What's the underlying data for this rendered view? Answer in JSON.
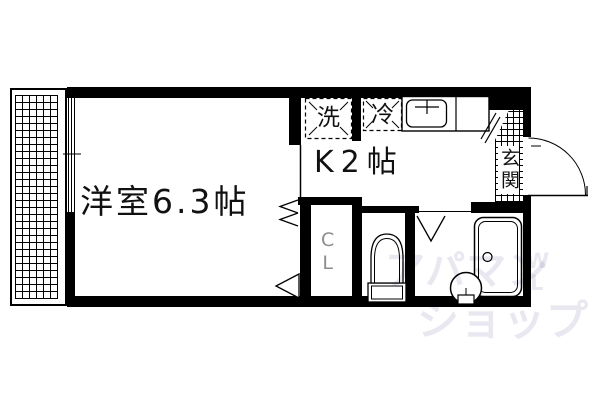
{
  "floorplan": {
    "title": "1K apartment floor plan",
    "rooms": {
      "western_room": {
        "label": "洋室6.3帖"
      },
      "kitchen": {
        "label": "K2帖"
      },
      "entrance": {
        "label": "玄関"
      },
      "closet": {
        "letter_c": "C",
        "letter_l": "L"
      }
    },
    "fixtures": {
      "washer": {
        "label": "洗"
      },
      "fridge": {
        "label": "冷"
      }
    },
    "watermark": {
      "line1": "アパマン",
      "line2": "ショップ",
      "extra_w": "W",
      "extra_l": "L",
      "color": "#e9e7f0"
    },
    "colors": {
      "wall": "#000000",
      "background": "#ffffff",
      "closet_text": "#8d8d8d"
    }
  }
}
